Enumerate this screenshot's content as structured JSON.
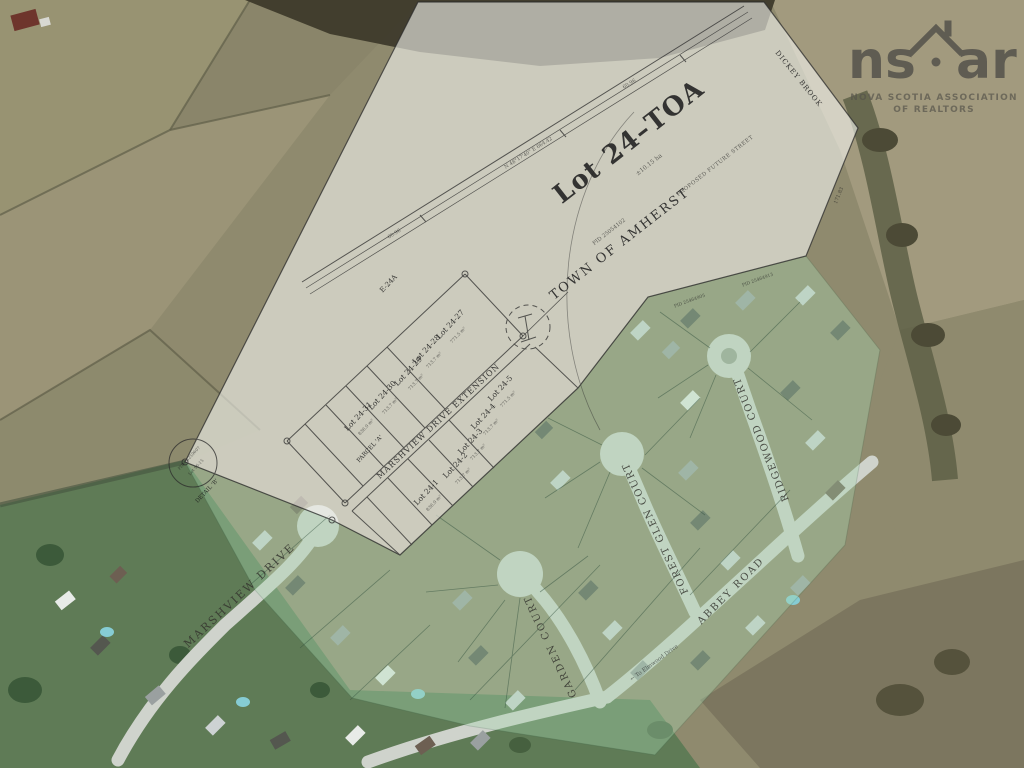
{
  "watermark": {
    "ns": "ns",
    "ar": "ar",
    "line1": "NOVA SCOTIA ASSOCIATION",
    "line2": "OF REALTORS",
    "color": "#514f49"
  },
  "plan": {
    "title": "Lot 24–TOA",
    "title_area": "±10.15 ha",
    "owner": "TOWN OF AMHERST",
    "owner_pid": "PID 25054102",
    "future_street": "PROPOSED FUTURE STREET",
    "brook": "DICKEY BROOK",
    "remnant": "E-24A",
    "parcel_a": "PARCEL 'A'",
    "detail_label": "DETAIL 'B'",
    "detail_line1": "PID 25259607",
    "detail_line2": "Lot 96-15",
    "bearing_top": "N 48°17'40\" E   664.42",
    "tick_a": "60.96",
    "tick_b": "60.96",
    "tick_c": "171.83",
    "pid_a": "PID 25464905",
    "pid_b": "PID 25464913",
    "lots_west": [
      {
        "label": "Lot 24-27",
        "area": "771.5 m²"
      },
      {
        "label": "Lot 24-28",
        "area": "713.7 m²"
      },
      {
        "label": "Lot 24-29",
        "area": "713.7 m²"
      },
      {
        "label": "Lot 24-30",
        "area": "713.7 m²"
      },
      {
        "label": "Lot 24-31",
        "area": "836.0 m²"
      }
    ],
    "lots_east": [
      {
        "label": "Lot 24-1",
        "area": "836.0 m²"
      },
      {
        "label": "Lot 24-2",
        "area": "713.7 m²"
      },
      {
        "label": "Lot 24-3",
        "area": "713.7 m²"
      },
      {
        "label": "Lot 24-4",
        "area": "713.7 m²"
      },
      {
        "label": "Lot 24-5",
        "area": "771.5 m²"
      }
    ]
  },
  "streets": {
    "marshview": "MARSHVIEW DRIVE",
    "extension": "MARSHVIEW DRIVE EXTENSION",
    "garden": "GARDEN COURT",
    "forest": "FOREST GLEN COURT",
    "ridgewood": "RIDGEWOOD COURT",
    "abbey": "ABBEY ROAD",
    "elmwood_note": "← To Elmwood Drive"
  }
}
